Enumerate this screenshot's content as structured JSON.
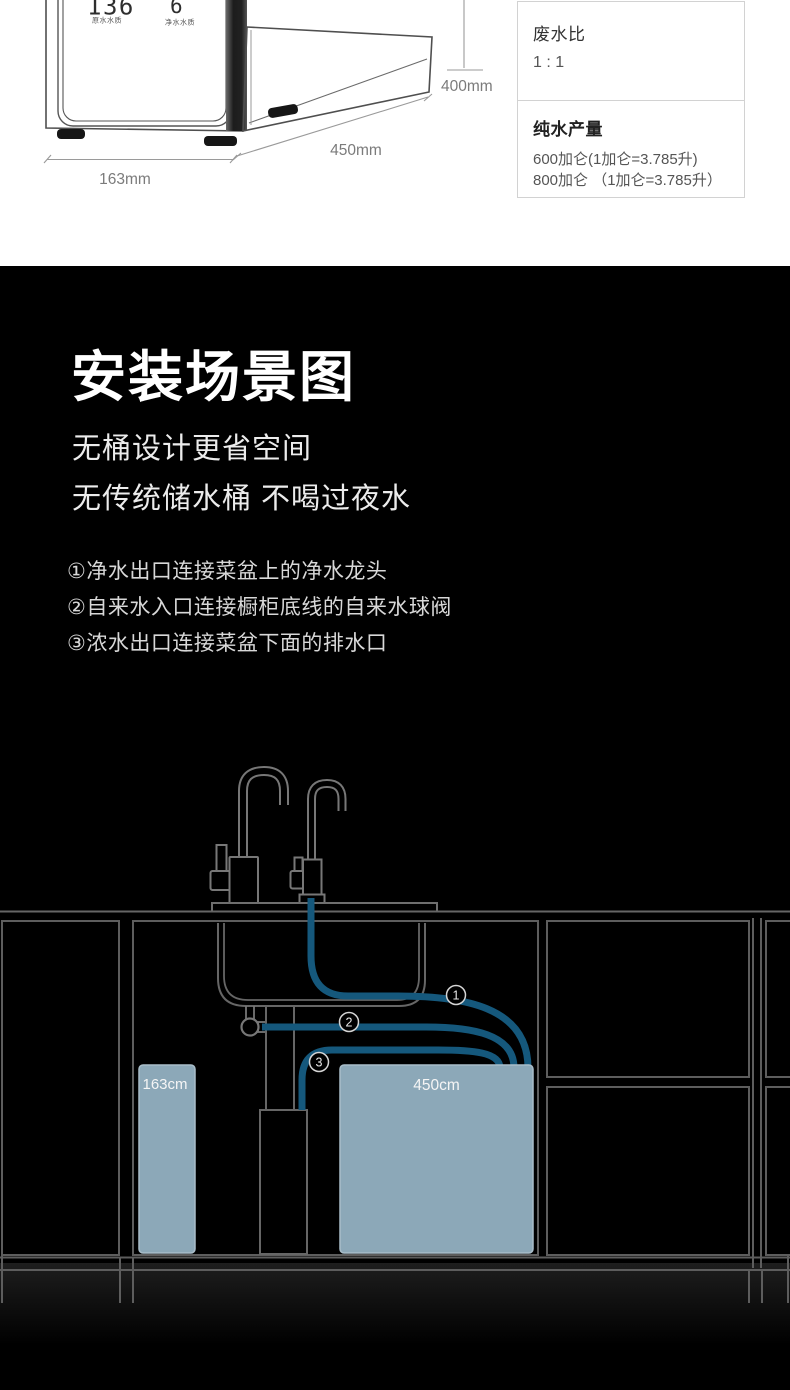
{
  "product": {
    "display": {
      "raw_value": "136",
      "raw_label": "原水水质",
      "pure_value": "6",
      "pure_label": "净水水质"
    },
    "dimensions": {
      "width": "163mm",
      "depth": "450mm",
      "height": "400mm"
    }
  },
  "spec_table": {
    "rows": [
      {
        "label": "废水比",
        "lines": [
          "1 : 1"
        ]
      },
      {
        "label": "纯水产量",
        "lines": [
          "600加仑(1加仑=3.785升)",
          "800加仑 （1加仑=3.785升）"
        ]
      }
    ]
  },
  "scene": {
    "title": "安装场景图",
    "subtitle1": "无桶设计更省空间",
    "subtitle2": "无传统储水桶 不喝过夜水",
    "steps": [
      "①净水出口连接菜盆上的净水龙头",
      "②自来水入口连接橱柜底线的自来水球阀",
      "③浓水出口连接菜盆下面的排水口"
    ]
  },
  "diagram": {
    "marker1": "1",
    "marker2": "2",
    "marker3": "3",
    "left_box_label": "163cm",
    "right_box_label": "450cm",
    "colors": {
      "pipe": "#15587C",
      "box_fill": "#8CA8B8",
      "box_border": "#A9BDC9",
      "cabinet_line": "#5d5d5d"
    }
  }
}
